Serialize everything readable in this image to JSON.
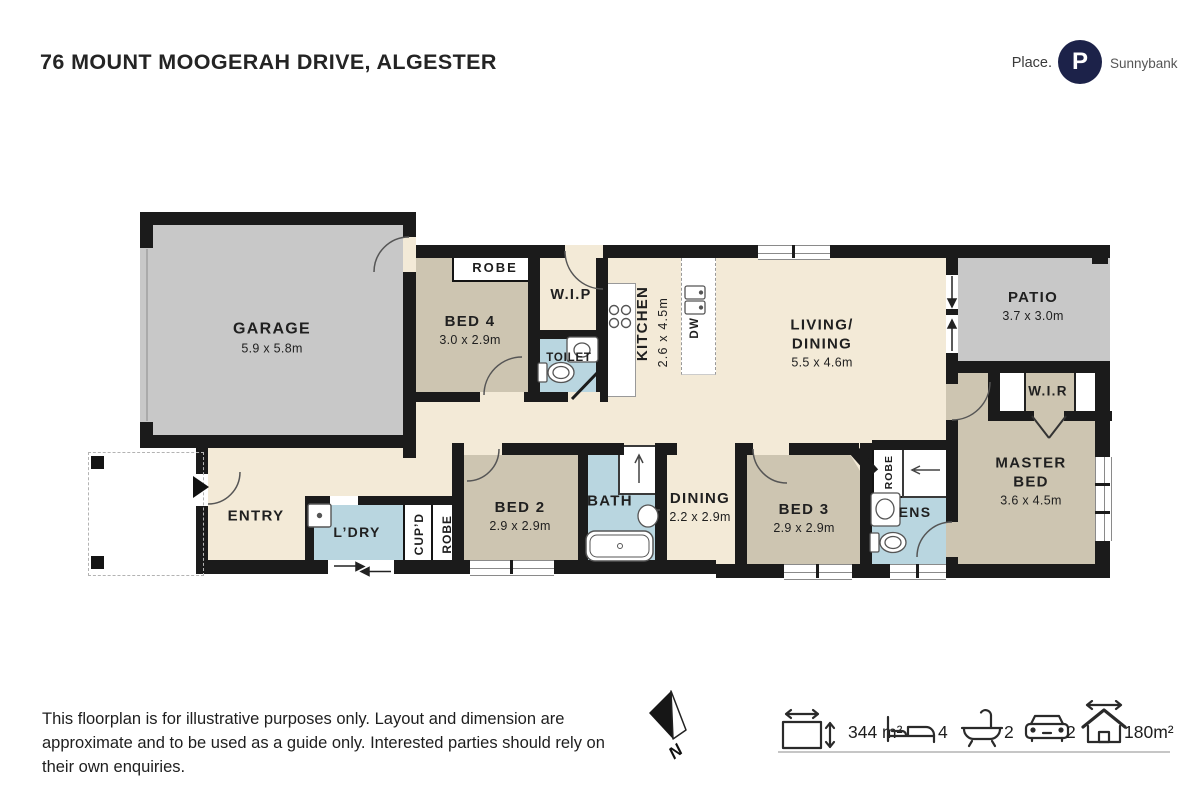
{
  "header": {
    "title": "76 MOUNT MOOGERAH DRIVE, ALGESTER"
  },
  "brand": {
    "prefix": "Place.",
    "monogram": "P",
    "office": "Sunnybank"
  },
  "rooms": {
    "garage": {
      "label": "GARAGE",
      "dims": "5.9 x 5.8m"
    },
    "bed4": {
      "label": "BED 4",
      "dims": "3.0 x 2.9m"
    },
    "robe_bed4": {
      "label": "ROBE"
    },
    "wip": {
      "label": "W.I.P"
    },
    "toilet": {
      "label": "TOILET"
    },
    "kitchen": {
      "label": "KITCHEN",
      "dims": "2.6 x 4.5m"
    },
    "dw": {
      "label": "DW"
    },
    "living": {
      "label1": "LIVING/",
      "label2": "DINING",
      "dims": "5.5 x 4.6m"
    },
    "patio": {
      "label": "PATIO",
      "dims": "3.7 x 3.0m"
    },
    "wir": {
      "label": "W.I.R"
    },
    "master": {
      "label1": "MASTER",
      "label2": "BED",
      "dims": "3.6 x 4.5m"
    },
    "entry": {
      "label": "ENTRY"
    },
    "ldry": {
      "label": "L’DRY"
    },
    "cupd": {
      "label": "CUP’D"
    },
    "robe_hall": {
      "label": "ROBE"
    },
    "bed2": {
      "label": "BED 2",
      "dims": "2.9 x 2.9m"
    },
    "bath": {
      "label": "BATH"
    },
    "dining": {
      "label": "DINING",
      "dims": "2.2 x 2.9m"
    },
    "bed3": {
      "label": "BED 3",
      "dims": "2.9 x 2.9m"
    },
    "robe_bed3": {
      "label": "ROBE"
    },
    "ens": {
      "label": "ENS"
    }
  },
  "compass": {
    "label": "N"
  },
  "stats": {
    "land": {
      "icon": "land-area-icon",
      "value": "344 m²"
    },
    "beds": {
      "icon": "bed-icon",
      "value": "4"
    },
    "baths": {
      "icon": "bath-icon",
      "value": "2"
    },
    "cars": {
      "icon": "car-icon",
      "value": "2"
    },
    "house": {
      "icon": "house-area-icon",
      "value": "180m²"
    }
  },
  "disclaimer": "This floorplan is for illustrative purposes only. Layout and dimension are approximate and to be used as a guide only. Interested parties should rely on their own enquiries.",
  "colors": {
    "wall": "#1b1b1b",
    "floor_cream": "#f3ead7",
    "room_tan": "#cdc5b1",
    "wet_blue": "#b9d6e0",
    "garage_grey": "#c8c8c8",
    "logo_navy": "#1c2249"
  }
}
